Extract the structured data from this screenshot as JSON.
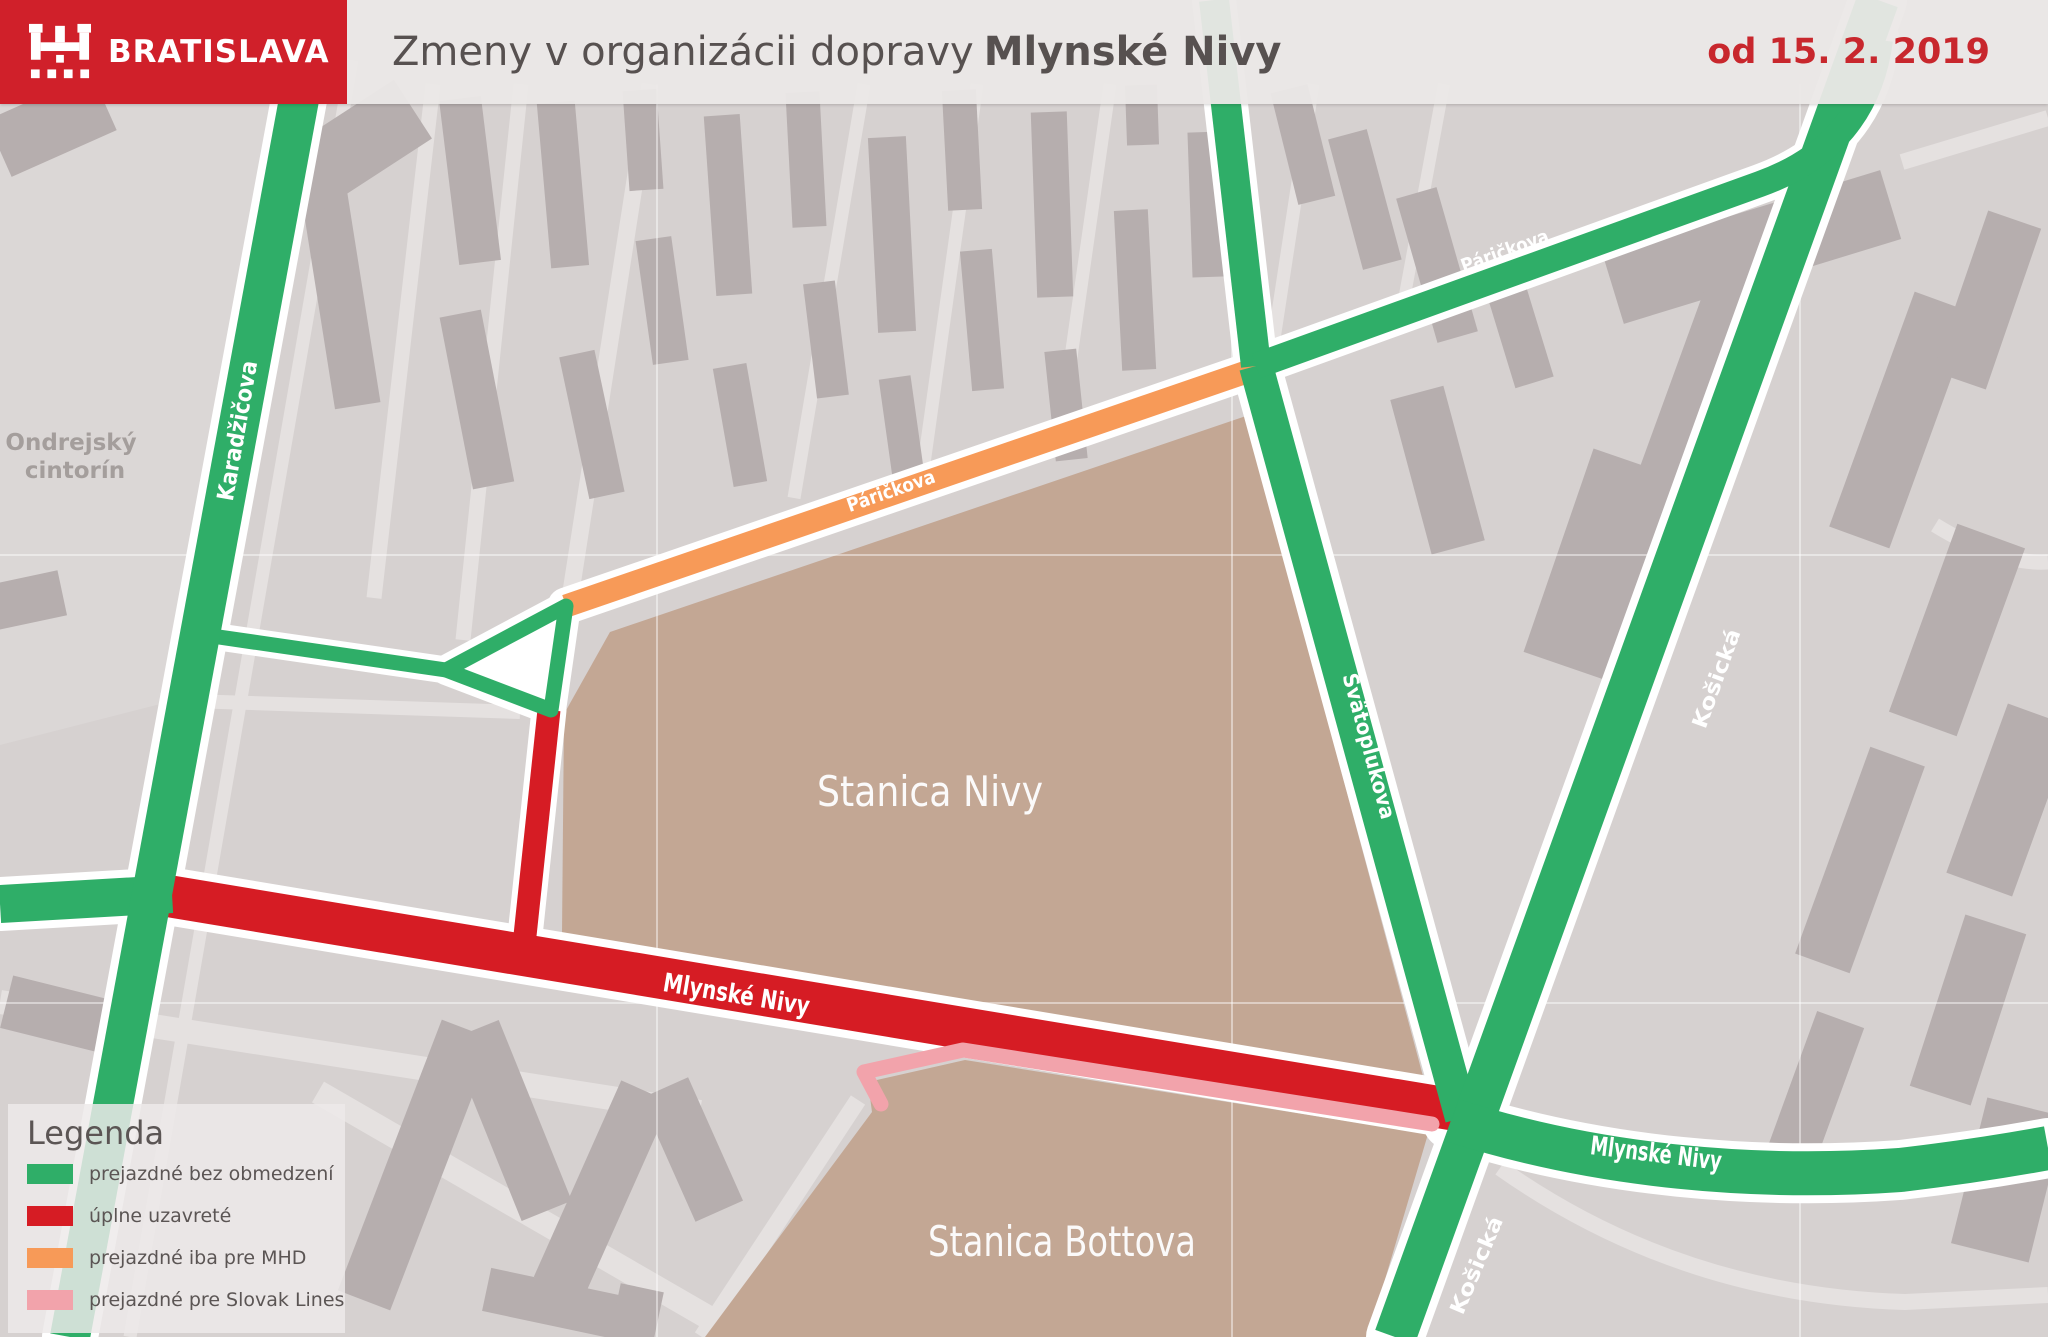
{
  "header": {
    "logo_text": "BRATISLAVA",
    "title": {
      "regular": "Zmeny v organizácii dopravy",
      "bold": "Mlynské Nivy"
    },
    "date": "od 15. 2. 2019",
    "brand_color": "#d0202a",
    "title_color": "#575150",
    "date_color": "#c8272d"
  },
  "legend": {
    "title": "Legenda",
    "items": [
      {
        "label": "prejazdné bez obmedzení",
        "color": "#2fae68",
        "status": "open"
      },
      {
        "label": "úplne uzavreté",
        "color": "#d61c24",
        "status": "closed"
      },
      {
        "label": "prejazdné iba pre MHD",
        "color": "#f79a58",
        "status": "mhd-only"
      },
      {
        "label": "prejazdné pre Slovak Lines",
        "color": "#f2a3ab",
        "status": "slovak-lines"
      }
    ]
  },
  "map": {
    "colors": {
      "road_open": "#2fae68",
      "road_closed": "#d61c24",
      "road_mhd": "#f79a58",
      "road_slovak_lines": "#f2a3ab",
      "station_area": "#c3a794"
    },
    "street_labels": {
      "karadzicova": "Karadžičova",
      "parickova_mhd": "Páričkova",
      "parickova_ne": "Páričkova",
      "svatoplukova": "Svätoplukova",
      "kosicka_north": "Košická",
      "kosicka_south": "Košická",
      "mlynske_nivy_closed": "Mlynské Nivy",
      "mlynske_nivy_east": "Mlynské Nivy"
    },
    "area_labels": {
      "cemetery_line1": "Ondrejský",
      "cemetery_line2": "cintorín",
      "stanica_nivy": "Stanica Nivy",
      "stanica_bottova": "Stanica Bottova"
    }
  }
}
